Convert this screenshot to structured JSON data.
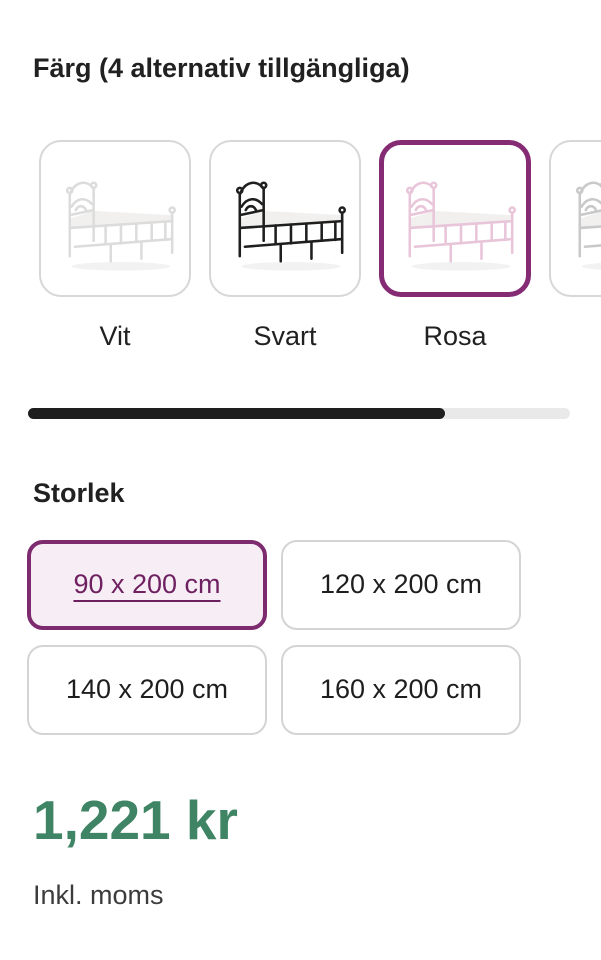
{
  "color_section": {
    "title": "Färg (4 alternativ tillgängliga)",
    "options": [
      {
        "label": "Vit",
        "selected": false,
        "swatch_stroke": "#dcdcdc"
      },
      {
        "label": "Svart",
        "selected": false,
        "swatch_stroke": "#1f1f1f"
      },
      {
        "label": "Rosa",
        "selected": true,
        "swatch_stroke": "#e8c5d9"
      },
      {
        "label": "",
        "selected": false,
        "swatch_stroke": "#c9c9c9",
        "partially_visible": true
      }
    ]
  },
  "carousel": {
    "scroll_fraction": 0.77
  },
  "size_section": {
    "title": "Storlek",
    "options": [
      {
        "label": "90 x 200 cm",
        "selected": true
      },
      {
        "label": "120 x 200 cm",
        "selected": false
      },
      {
        "label": "140 x 200 cm",
        "selected": false
      },
      {
        "label": "160 x 200 cm",
        "selected": false
      }
    ]
  },
  "price": {
    "amount": "1,221 kr",
    "vat_note": "Inkl. moms"
  },
  "colors": {
    "accent_purple": "#7d2b6e",
    "selected_swatch_border": "#842b74",
    "selected_size_bg": "#f7eef5",
    "selected_size_text": "#6e2060",
    "price_green": "#3f8464",
    "scrollbar_thumb": "#1e1e1e",
    "scrollbar_track": "#e9e9e9",
    "card_border_gray": "#d7d7d7",
    "text_dark": "#212121"
  }
}
